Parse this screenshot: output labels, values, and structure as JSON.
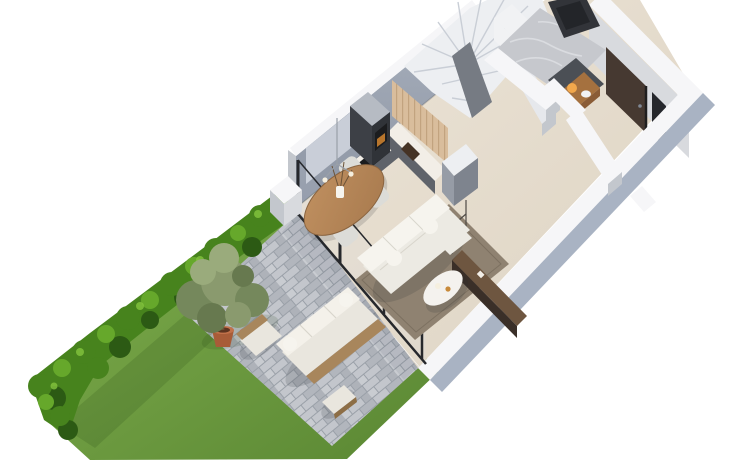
{
  "scene": {
    "type": "isometric-3d-floor-plan-render",
    "objects": [
      "garden-lawn",
      "boxwood-hedge",
      "olive-tree",
      "terracotta-pot",
      "stone-paver-patio",
      "outdoor-sofa",
      "outdoor-armchair",
      "outdoor-stool",
      "glass-sliding-wall",
      "open-plan-interior",
      "kitchen-l-shaped",
      "wood-slat-wall",
      "oven-column",
      "cooktop",
      "sink",
      "winder-staircase",
      "washing-machine",
      "bathroom-marble-floor",
      "wc-vanity",
      "entry-door",
      "dining-table-oval",
      "dining-chairs",
      "pendant-lamp",
      "sofa-l-shaped",
      "area-rug",
      "coffee-table",
      "media-sideboard",
      "shelf-frame",
      "window-panel"
    ],
    "palette": {
      "bg": "#ffffff",
      "lawn1": "#7fae4d",
      "lawn2": "#5a8733",
      "lawnShadow": "rgba(25,56,12,0.28)",
      "paverBase": "#9aa0a8",
      "paver1": "#c3c6cc",
      "paver2": "#b2b6bd",
      "paver3": "#c9ccd1",
      "paver4": "#aeb2b9",
      "patioShade": "rgba(70,80,100,0.10)",
      "hedgeDark": "#2c5a14",
      "hedgeMid": "#47831d",
      "hedgeLight": "#66a82b",
      "hedgeHi": "#84c43e",
      "olive1": "#8a9a6e",
      "olive2": "#75885c",
      "olive3": "#9aab7c",
      "olive4": "#67794f",
      "potTerra": "#a85c38",
      "potRim": "#c2714a",
      "potSoil": "#5e3420",
      "potGray": "#8d8a85",
      "trunk": "#6c5338",
      "floor1": "#ece4d7",
      "floor2": "#ddd3c2",
      "wallTop": "#f6f6f8",
      "wallFaceLight": "#d8dade",
      "wallFaceMed": "#c3c7cd",
      "wallOuterBlue": "#a9b3c3",
      "wallNW1": "#a8b0bd",
      "wallNW2": "#8d95a3",
      "windowPanel": "#c9ced8",
      "glassFrame": "#26282c",
      "glassSheen": "rgba(210,225,235,0.12)",
      "woodSlat": "#d9bd9c",
      "woodSlatLine": "#c2a37f",
      "cabinetFront": "#5f636a",
      "cabinetDark": "#3d4046",
      "cabinetDarker": "#303338",
      "cabinetTop": "#b6bbc3",
      "counterTop": "#f2eee7",
      "hob": "#1b1c1e",
      "sinkBrown": "#453325",
      "ovenGlow": "#c97f2d",
      "peninsulaFace": "#969ca6",
      "peninsulaSide": "#7e848e",
      "stairWhite": "#edeff2",
      "stairLine": "#c9ced6",
      "stairCore": "#767b83",
      "stairWall": "#e6e8ec",
      "marble": "#c6c8cd",
      "marbleVein": "#dfe1e5",
      "darkDoorway": "#323439",
      "darkDoorway2": "#232529",
      "washerBody": "#f1f2f4",
      "washerSide": "#d6d9df",
      "washerDoor": "#2e3035",
      "washerRing": "#808894",
      "wcNiche": "#4b4f55",
      "wcWood": "#8a5c36",
      "wcWoodTop": "#a5713f",
      "glow": "#ffb24f",
      "doorBrown": "#463931",
      "doorFrame": "#201f1f",
      "sidelight": "#25272c",
      "tableWood1": "#c09060",
      "tableWood2": "#a87a4e",
      "tableEdge": "#8a6440",
      "chairGray": "#dcdcd8",
      "chairEdge": "#c4c4be",
      "rug": "#8f8271",
      "rugEdge": "#7c7060",
      "sofaBase": "#eceae3",
      "sofaCushion": "#f6f4ee",
      "sofaTrim": "#d8d5cc",
      "tableWhite": "#f4f2ee",
      "tableWhiteEdge": "#dcd9d2",
      "decoOrange": "#c88a3a",
      "sideboardTop": "#6e5640",
      "sideboardFront": "#3a2f28",
      "frameMetal": "#4e4a45",
      "pendantMetal": "#9aa0a8",
      "bulb": "#f5efdf",
      "outWood": "#a8865c",
      "outWoodDark": "#8d6e46",
      "outCushion": "#e9e6de",
      "outCushionHi": "#f4f1ea",
      "shadow": "rgba(40,42,50,0.16)",
      "baseLine": "rgba(0,0,0,0.15)"
    }
  }
}
